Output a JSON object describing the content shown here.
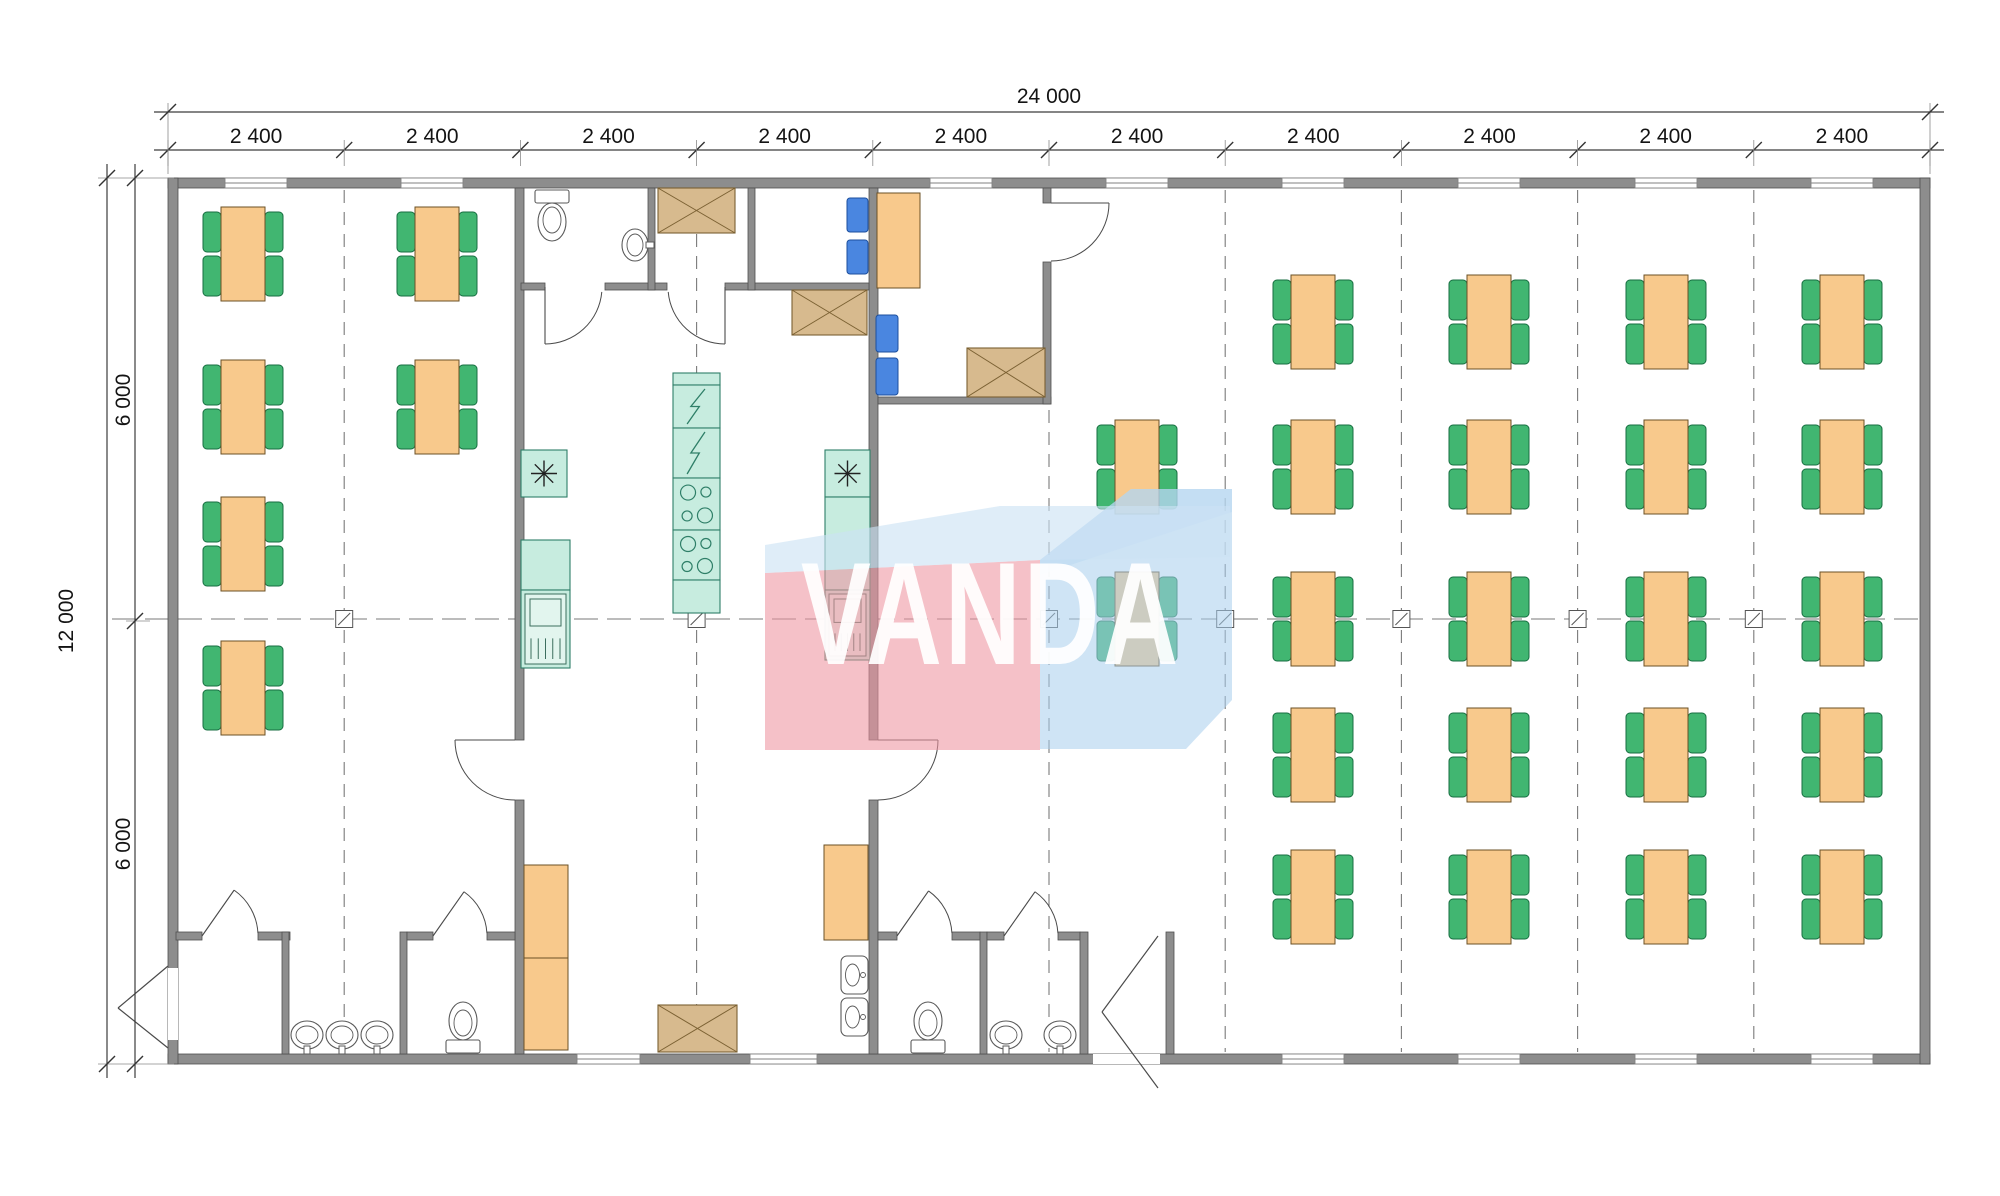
{
  "watermark": {
    "text": "VANDA",
    "shapes": [
      {
        "name": "watermark-light-top-face",
        "points": "765,545 1000,506 1230,506 1230,557 1040,560 765,573",
        "fill": "rgba(203,226,243,0.62)"
      },
      {
        "name": "watermark-red-block",
        "points": "765,573 1040,560 1040,750 765,750",
        "fill": "rgba(238,148,160,0.58)"
      },
      {
        "name": "watermark-blue-block",
        "points": "1040,560 1131,489 1232,489 1232,700 1186,749 1040,749",
        "fill": "rgba(168,205,237,0.55)"
      },
      {
        "name": "watermark-blue-top-face",
        "points": "1040,560 1131,489 1232,489 1232,512 1040,575",
        "fill": "rgba(210,231,246,0.55)"
      }
    ]
  },
  "dimensions": {
    "top_total_label": "24 000",
    "top_segment_labels": [
      "2 400",
      "2 400",
      "2 400",
      "2 400",
      "2 400",
      "2 400",
      "2 400",
      "2 400",
      "2 400",
      "2 400"
    ],
    "left_total_label": "12 000",
    "left_segment_labels": [
      "6 000",
      "6 000"
    ],
    "top_total": {
      "y": 112,
      "x1": 168,
      "x2": 1930,
      "label_x": 1049,
      "label_y": 103
    },
    "top_seg": {
      "y": 150,
      "label_y": 143,
      "ticks": [
        168,
        344.2,
        520.4,
        696.6,
        872.8,
        1049,
        1225.2,
        1401.4,
        1577.6,
        1753.8,
        1930
      ],
      "centers": [
        256.1,
        432.3,
        608.5,
        784.7,
        960.9,
        1137.1,
        1313.3,
        1489.5,
        1665.7,
        1841.9
      ]
    },
    "left_total": {
      "x": 107,
      "y1": 178,
      "y2": 1064,
      "label_x": 66,
      "label_y": 621
    },
    "left_seg": {
      "x": 135,
      "ticks": [
        178,
        621,
        1064
      ],
      "label_pos": [
        [
          123,
          400
        ],
        [
          123,
          844
        ]
      ]
    },
    "ext_lines": [
      [
        168,
        103,
        168,
        174
      ],
      [
        1930,
        103,
        1930,
        174
      ],
      [
        98,
        178,
        174,
        178
      ],
      [
        98,
        1064,
        174,
        1064
      ],
      [
        126,
        621,
        150,
        621
      ]
    ]
  },
  "colors": {
    "wall": "#8d8d8d",
    "wall_edge": "#4f4f4f",
    "table": "#f8c98c",
    "table_edge": "#6b5126",
    "chair": "#41b671",
    "chair_edge": "#176e41",
    "blue_chair": "#4a86e0",
    "blue_chair_edge": "#1c4f9e",
    "cabinet": "#d7ba8e",
    "cabinet_edge": "#7b6133",
    "appliance": "#c7ecdf",
    "appliance_edge": "#2f7f68",
    "sanitary_edge": "#5a5a5a",
    "grid": "#7a7a7a",
    "dim": "#3c3c3c",
    "door": "#4a4a4a"
  },
  "floorplan": {
    "building": {
      "x1": 168,
      "y1": 178,
      "x2": 1930,
      "y2": 1064,
      "wall": 10
    },
    "grid": {
      "v": [
        {
          "x": 344.2,
          "y1": 190,
          "y2": 1052
        },
        {
          "x": 696.6,
          "y1": 190,
          "y2": 1052
        },
        {
          "x": 1049,
          "y1": 410,
          "y2": 1052
        },
        {
          "x": 1225.2,
          "y1": 190,
          "y2": 1052
        },
        {
          "x": 1401.4,
          "y1": 190,
          "y2": 1052
        },
        {
          "x": 1577.6,
          "y1": 190,
          "y2": 1052
        },
        {
          "x": 1753.8,
          "y1": 190,
          "y2": 1052
        }
      ],
      "h": {
        "y": 619,
        "x1": 112,
        "x2": 1930
      },
      "markers": [
        344.2,
        696.6,
        1049,
        1225.2,
        1401.4,
        1577.6,
        1753.8
      ]
    },
    "walls": [
      [
        168,
        178,
        1762,
        10
      ],
      [
        168,
        1054,
        1762,
        10
      ],
      [
        168,
        178,
        10,
        886
      ],
      [
        1920,
        178,
        10,
        886
      ],
      [
        515,
        188,
        9,
        552
      ],
      [
        515,
        800,
        9,
        254
      ],
      [
        869,
        188,
        9,
        552
      ],
      [
        869,
        800,
        9,
        254
      ],
      [
        521,
        283,
        24,
        7
      ],
      [
        605,
        283,
        62,
        7
      ],
      [
        725,
        283,
        144,
        7
      ],
      [
        648,
        188,
        7,
        102
      ],
      [
        748,
        188,
        7,
        102
      ],
      [
        878,
        397,
        173,
        7
      ],
      [
        1043,
        188,
        8,
        15
      ],
      [
        1043,
        262,
        8,
        142
      ],
      [
        176,
        932,
        26,
        8
      ],
      [
        258,
        932,
        32,
        8
      ],
      [
        282,
        932,
        7,
        122
      ],
      [
        400,
        932,
        7,
        122
      ],
      [
        407,
        932,
        26,
        8
      ],
      [
        487,
        932,
        28,
        8
      ],
      [
        878,
        932,
        19,
        8
      ],
      [
        952,
        932,
        28,
        8
      ],
      [
        980,
        932,
        7,
        122
      ],
      [
        987,
        932,
        17,
        8
      ],
      [
        1058,
        932,
        22,
        8
      ],
      [
        1080,
        932,
        8,
        122
      ],
      [
        1166,
        932,
        8,
        122
      ]
    ],
    "windows": [
      [
        225,
        178,
        62,
        10
      ],
      [
        401,
        178,
        62,
        10
      ],
      [
        930,
        178,
        62,
        10
      ],
      [
        1106,
        178,
        62,
        10
      ],
      [
        1282,
        178,
        62,
        10
      ],
      [
        1458,
        178,
        62,
        10
      ],
      [
        1635,
        178,
        62,
        10
      ],
      [
        1811,
        178,
        62,
        10
      ],
      [
        577,
        1054,
        63,
        10
      ],
      [
        750,
        1054,
        67,
        10
      ],
      [
        1282,
        1054,
        62,
        10
      ],
      [
        1458,
        1054,
        62,
        10
      ],
      [
        1635,
        1054,
        62,
        10
      ],
      [
        1811,
        1054,
        62,
        10
      ]
    ],
    "door_gaps": [
      [
        1093,
        1054,
        67,
        10
      ],
      [
        168,
        968,
        10,
        72
      ]
    ],
    "door_arcs": [
      {
        "p": [
          202,
          936
        ],
        "r": 56,
        "leaf": -55,
        "wall": -3
      },
      {
        "p": [
          433,
          936
        ],
        "r": 54,
        "leaf": -55,
        "wall": -3
      },
      {
        "p": [
          897,
          936
        ],
        "r": 55,
        "leaf": -55,
        "wall": -3
      },
      {
        "p": [
          1004,
          936
        ],
        "r": 54,
        "leaf": -55,
        "wall": -3
      },
      {
        "p": [
          515,
          740
        ],
        "r": 60,
        "leaf": 180,
        "wall": 90
      },
      {
        "p": [
          878,
          740
        ],
        "r": 60,
        "leaf": 0,
        "wall": 90
      },
      {
        "p": [
          1051,
          203
        ],
        "r": 58,
        "leaf": 0,
        "wall": 90
      },
      {
        "p": [
          545,
          287
        ],
        "r": 57,
        "leaf": 90,
        "wall": 5
      },
      {
        "p": [
          725,
          287
        ],
        "r": 57,
        "leaf": 90,
        "wall": 175
      }
    ],
    "door_lines": [
      [
        168,
        966,
        118,
        1008
      ],
      [
        118,
        1008,
        168,
        1048
      ],
      [
        1158,
        936,
        1102,
        1012
      ],
      [
        1102,
        1012,
        1158,
        1088
      ]
    ],
    "tables": [
      [
        243,
        207
      ],
      [
        243,
        360
      ],
      [
        243,
        497
      ],
      [
        243,
        641
      ],
      [
        437,
        207
      ],
      [
        437,
        360
      ],
      [
        1137,
        420
      ],
      [
        1137,
        572
      ],
      [
        1313,
        275
      ],
      [
        1313,
        420
      ],
      [
        1313,
        572
      ],
      [
        1313,
        708
      ],
      [
        1313,
        850
      ],
      [
        1489,
        275
      ],
      [
        1489,
        420
      ],
      [
        1489,
        572
      ],
      [
        1489,
        708
      ],
      [
        1489,
        850
      ],
      [
        1666,
        275
      ],
      [
        1666,
        420
      ],
      [
        1666,
        572
      ],
      [
        1666,
        708
      ],
      [
        1666,
        850
      ],
      [
        1842,
        275
      ],
      [
        1842,
        420
      ],
      [
        1842,
        572
      ],
      [
        1842,
        708
      ],
      [
        1842,
        850
      ]
    ],
    "table_geom": {
      "tw": 44,
      "th": 94,
      "cw": 18,
      "ch": 40
    },
    "desk": [
      877,
      193,
      43,
      95
    ],
    "blue_chairs": [
      [
        847,
        198,
        21,
        34
      ],
      [
        847,
        240,
        21,
        34
      ],
      [
        876,
        315,
        22,
        37
      ],
      [
        876,
        358,
        22,
        37
      ]
    ],
    "cross_boxes": [
      [
        658,
        188,
        77,
        45
      ],
      [
        792,
        290,
        75,
        45
      ],
      [
        967,
        348,
        78,
        49
      ],
      [
        658,
        1005,
        79,
        47
      ]
    ],
    "kitchen_units": [
      {
        "x": 673,
        "y": 373,
        "w": 47,
        "h": 12,
        "kind": "plain"
      },
      {
        "x": 673,
        "y": 385,
        "w": 47,
        "h": 43,
        "kind": "bolt"
      },
      {
        "x": 673,
        "y": 428,
        "w": 47,
        "h": 50,
        "kind": "bolt"
      },
      {
        "x": 673,
        "y": 478,
        "w": 47,
        "h": 52,
        "kind": "burners"
      },
      {
        "x": 673,
        "y": 530,
        "w": 47,
        "h": 50,
        "kind": "burners"
      },
      {
        "x": 673,
        "y": 580,
        "w": 47,
        "h": 33,
        "kind": "plain"
      },
      {
        "x": 521,
        "y": 450,
        "w": 46,
        "h": 47,
        "kind": "star"
      },
      {
        "x": 521,
        "y": 540,
        "w": 49,
        "h": 50,
        "kind": "plain"
      },
      {
        "x": 521,
        "y": 590,
        "w": 49,
        "h": 78,
        "kind": "panel"
      },
      {
        "x": 825,
        "y": 450,
        "w": 45,
        "h": 47,
        "kind": "star"
      },
      {
        "x": 825,
        "y": 497,
        "w": 45,
        "h": 93,
        "kind": "plain"
      },
      {
        "x": 825,
        "y": 590,
        "w": 45,
        "h": 70,
        "kind": "panel"
      }
    ],
    "orange_cabinets": [
      [
        524,
        865,
        44,
        93
      ],
      [
        524,
        958,
        44,
        92
      ],
      [
        824,
        845,
        44,
        95
      ]
    ],
    "kitchen_sinks": [
      [
        841,
        956,
        27,
        38
      ],
      [
        841,
        998,
        27,
        38
      ]
    ],
    "toilets": [
      {
        "cx": 552,
        "dir": "down",
        "ty": 190
      },
      {
        "cx": 463,
        "dir": "up",
        "ty": 1040
      },
      {
        "cx": 928,
        "dir": "up",
        "ty": 1040
      }
    ],
    "wall_sinks": [
      {
        "cx": 635,
        "cy": 245,
        "tap": "right"
      },
      {
        "cx": 307,
        "cy": 1035,
        "tap": "down"
      },
      {
        "cx": 342,
        "cy": 1035,
        "tap": "down"
      },
      {
        "cx": 377,
        "cy": 1035,
        "tap": "down"
      },
      {
        "cx": 1006,
        "cy": 1035,
        "tap": "down"
      },
      {
        "cx": 1060,
        "cy": 1035,
        "tap": "down"
      }
    ]
  }
}
